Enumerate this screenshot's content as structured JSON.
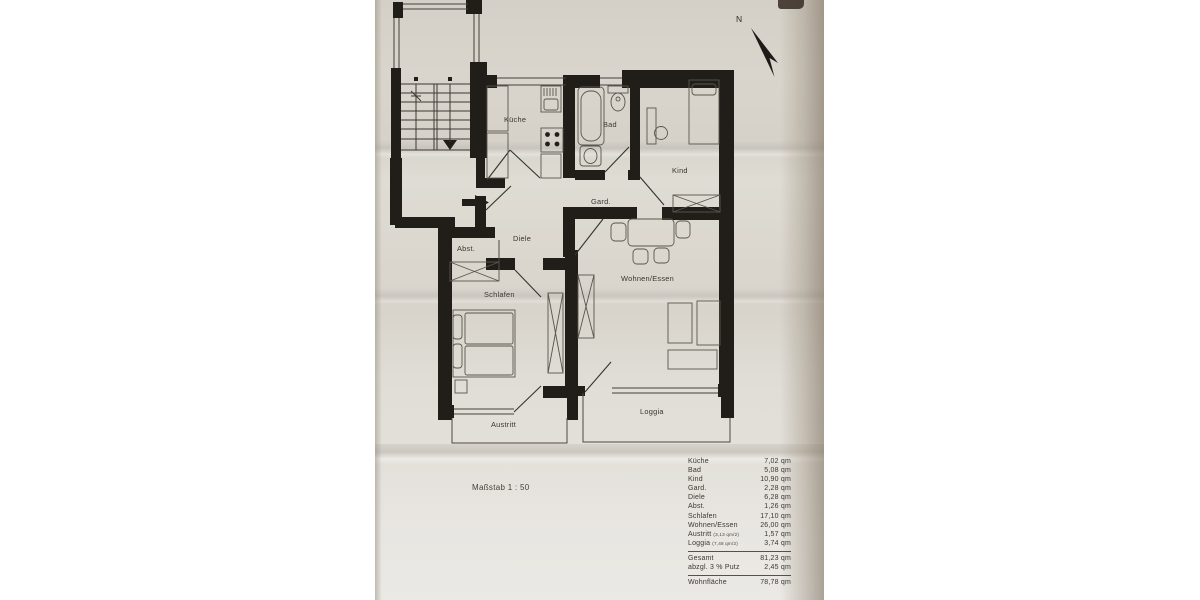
{
  "page": {
    "north_label": "N",
    "scale_label": "Maßstab 1 : 50"
  },
  "plan": {
    "rooms": {
      "kueche": "Küche",
      "bad": "Bad",
      "kind": "Kind",
      "gard": "Gard.",
      "diele": "Diele",
      "abst": "Abst.",
      "schlafen": "Schlafen",
      "wohnen_essen": "Wohnen/Essen",
      "austritt": "Austritt",
      "loggia": "Loggia"
    }
  },
  "area_table": {
    "rows": [
      {
        "label": "Küche",
        "value": "7,02 qm"
      },
      {
        "label": "Bad",
        "value": "5,08 qm"
      },
      {
        "label": "Kind",
        "value": "10,90 qm"
      },
      {
        "label": "Gard.",
        "value": "2,28 qm"
      },
      {
        "label": "Diele",
        "value": "6,28 qm"
      },
      {
        "label": "Abst.",
        "value": "1,26 qm"
      },
      {
        "label": "Schlafen",
        "value": "17,10 qm"
      },
      {
        "label": "Wohnen/Essen",
        "value": "26,00 qm"
      },
      {
        "label": "Austritt",
        "note": "(3,13 qm/2)",
        "value": "1,57 qm"
      },
      {
        "label": "Loggia",
        "note": "(7,48 qm/2)",
        "value": "3,74 qm"
      }
    ],
    "summary": [
      {
        "label": "Gesamt",
        "value": "81,23 qm"
      },
      {
        "label": "abzgl. 3 % Putz",
        "value": "2,45 qm"
      }
    ],
    "total": {
      "label": "Wohnfläche",
      "value": "78,78 qm"
    }
  }
}
